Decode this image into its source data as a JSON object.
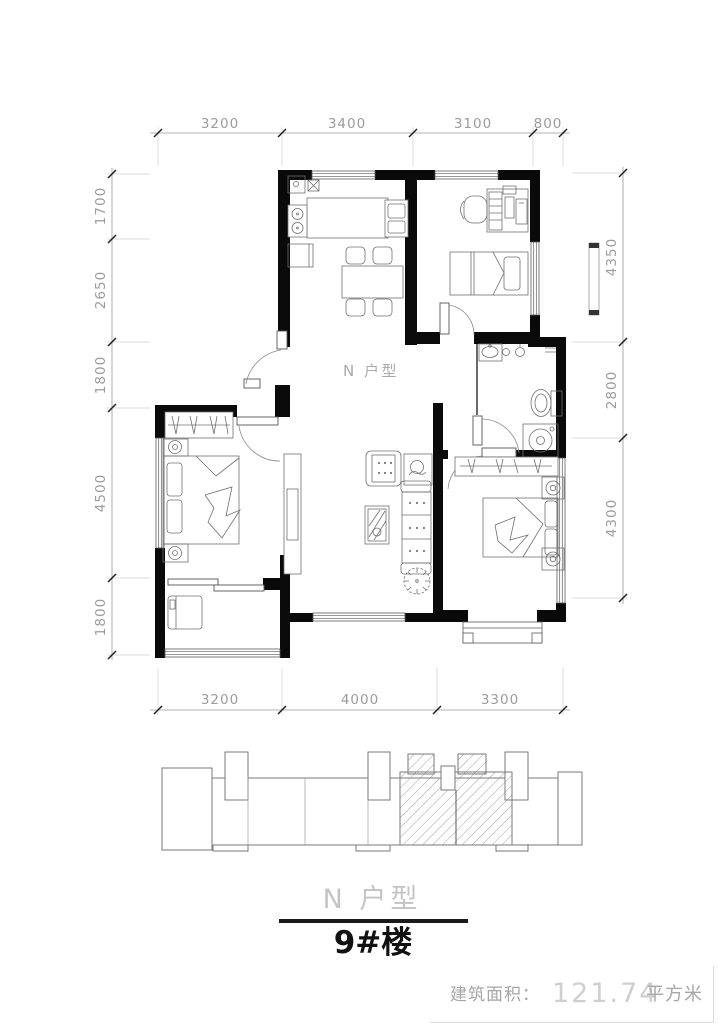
{
  "floor_plan": {
    "room_label": "N 户型",
    "dimensions": {
      "top": [
        "3200",
        "3400",
        "3100",
        "800"
      ],
      "left": [
        "1700",
        "2650",
        "1800",
        "4500",
        "1800"
      ],
      "right": [
        "4350",
        "2800",
        "4300"
      ],
      "bottom": [
        "3200",
        "4000",
        "3300"
      ]
    }
  },
  "key_plan": {
    "label": "N 户型"
  },
  "building_title": "9#楼",
  "area_caption": {
    "prefix": "建筑面积：",
    "value": "121.74",
    "unit": "平方米"
  },
  "colors": {
    "wall": "#0a0a0a",
    "dimension_text": "#9b9b9b",
    "furniture_line": "#707070",
    "light_text": "#c4c4c4",
    "title_text": "#111111"
  }
}
